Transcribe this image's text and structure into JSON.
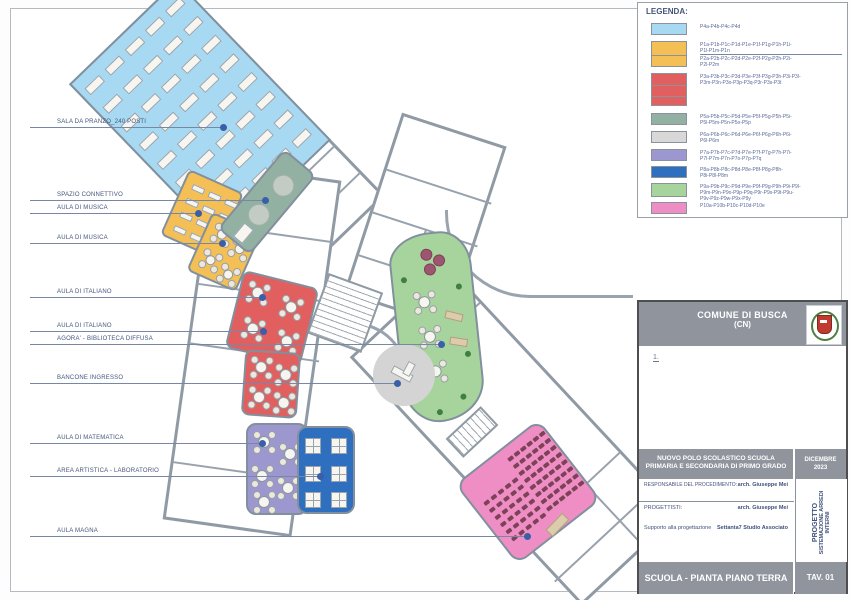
{
  "legend": {
    "title": "LEGENDA:",
    "items": [
      {
        "color": "#a8d9f2",
        "cells": 1,
        "lines": [
          "P4a-P4b-P4c-P4d"
        ]
      },
      {
        "color": "#f4bf54",
        "cells": 2,
        "lines": [
          "P1a-P1b-P1c-P1d-P1e-P1f-P1g-P1h-P1i-",
          "P1l-P1m-P1n"
        ],
        "lines2": [
          "P2a-P2b-P2c-P2d-P2e-P2f-P2g-P2h-P2i-",
          "P2l-P2m"
        ]
      },
      {
        "color": "#e25f5f",
        "cells": 3,
        "lines": [
          "P3a-P3b-P3c-P3d-P3e-P3f-P3g-P3h-P3i-P3l-",
          "P3m-P3n-P3o-P3p-P3q-P3r-P3s-P3t"
        ]
      },
      {
        "color": "#93b1a3",
        "cells": 1,
        "lines": [
          "P5a-P5b-P5c-P5d-P5e-P5f-P5g-P5h-P5i-",
          "P5l-P5m-P5n-P5o-P5p"
        ]
      },
      {
        "color": "#d8d8d8",
        "cells": 1,
        "lines": [
          "P6a-P6b-P6c-P6d-P6e-P6f-P6g-P6h-P6i-",
          "P6l-P6m"
        ]
      },
      {
        "color": "#9d97d0",
        "cells": 1,
        "lines": [
          "P7a-P7b-P7c-P7d-P7e-P7f-P7g-P7h-P7i-",
          "P7l-P7m-P7n-P7o-P7p-P7q"
        ]
      },
      {
        "color": "#2e6fc0",
        "cells": 1,
        "lines": [
          "P8a-P8b-P8c-P8d-P8e-P8f-P8g-P8h-",
          "P8i-P8l-P8m"
        ]
      },
      {
        "color": "#a7d49c",
        "cells": 1,
        "lines": [
          "P9a-P9b-P9c-P9d-P9e-P9f-P9g-P9h-P9i-P9l-",
          "P9m-P9n-P9o-P9p-P9q-P9r-P9s-P9t-P9u-",
          "P9v-P9z-P9w-P9x-P9y"
        ]
      },
      {
        "color": "#ee8ec4",
        "cells": 1,
        "lines": [
          "P10a-P10b-P10c-P10d-P10e"
        ]
      }
    ]
  },
  "plan": {
    "labels": [
      {
        "text": "SALA DA PRANZO_240 POSTI",
        "y": 127,
        "x_end": 223
      },
      {
        "text": "SPAZIO CONNETTIVO",
        "y": 200,
        "x_end": 265
      },
      {
        "text": "AULA DI MUSICA",
        "y": 213,
        "x_end": 198
      },
      {
        "text": "AULA DI MUSICA",
        "y": 243,
        "x_end": 222
      },
      {
        "text": "AULA DI ITALIANO",
        "y": 297,
        "x_end": 262
      },
      {
        "text": "AULA DI ITALIANO",
        "y": 331,
        "x_end": 263
      },
      {
        "text": "AGORA' - BIBLIOTECA DIFFUSA",
        "y": 344,
        "x_end": 441
      },
      {
        "text": "BANCONE INGRESSO",
        "y": 383,
        "x_end": 397
      },
      {
        "text": "AULA DI MATEMATICA",
        "y": 443,
        "x_end": 262
      },
      {
        "text": "AREA ARTISTICA - LABORATORIO",
        "y": 476,
        "x_end": 320
      },
      {
        "text": "AULA MAGNA",
        "y": 536,
        "x_end": 527
      }
    ],
    "rooms": [
      {
        "id": "sala-da-pranzo",
        "name": "SALA DA PRANZO",
        "color": "#a8d9f2"
      },
      {
        "id": "aula-musica-1",
        "name": "AULA DI MUSICA",
        "color": "#f4bf54"
      },
      {
        "id": "aula-musica-2",
        "name": "AULA DI MUSICA",
        "color": "#f4bf54"
      },
      {
        "id": "spazio-connettivo",
        "name": "SPAZIO CONNETTIVO",
        "color": "#93b1a3"
      },
      {
        "id": "aula-italiano-1",
        "name": "AULA DI ITALIANO",
        "color": "#e25f5f"
      },
      {
        "id": "aula-italiano-2",
        "name": "AULA DI ITALIANO",
        "color": "#e25f5f"
      },
      {
        "id": "agora",
        "name": "AGORA' - BIBLIOTECA DIFFUSA",
        "color": "#a7d49c"
      },
      {
        "id": "bancone-ingresso",
        "name": "BANCONE INGRESSO",
        "color": "#d4d4d4"
      },
      {
        "id": "aula-matematica",
        "name": "AULA DI MATEMATICA",
        "color": "#9d97d0"
      },
      {
        "id": "area-artistica",
        "name": "AREA ARTISTICA - LABORATORIO",
        "color": "#2e6fc0"
      },
      {
        "id": "aula-magna",
        "name": "AULA MAGNA",
        "color": "#ee8ec4"
      }
    ]
  },
  "title_block": {
    "municipality": "COMUNE DI BUSCA",
    "province": "(CN)",
    "note_mark": "1.",
    "project_title_line1": "NUOVO POLO SCOLASTICO SCUOLA",
    "project_title_line2": "PRIMARIA E SECONDARIA DI PRIMO GRADO",
    "date_line1": "DICEMBRE",
    "date_line2": "2023",
    "rows": [
      {
        "label": "RESPONSABILE DEL PROCEDIMENTO:",
        "value": "arch. Giuseppe Mei"
      },
      {
        "label": "PROGETTISTI:",
        "value": "arch. Giuseppe Mei"
      },
      {
        "label": "Supporto alla progettazione",
        "value": "Settanta7 Studio Associato"
      }
    ],
    "side_label_1": "PROGETTO",
    "side_label_2": "SISTEMAZIONE ARREDI INTERNI",
    "sheet_title": "SCUOLA - PIANTA PIANO TERRA",
    "sheet_number": "TAV. 01"
  }
}
